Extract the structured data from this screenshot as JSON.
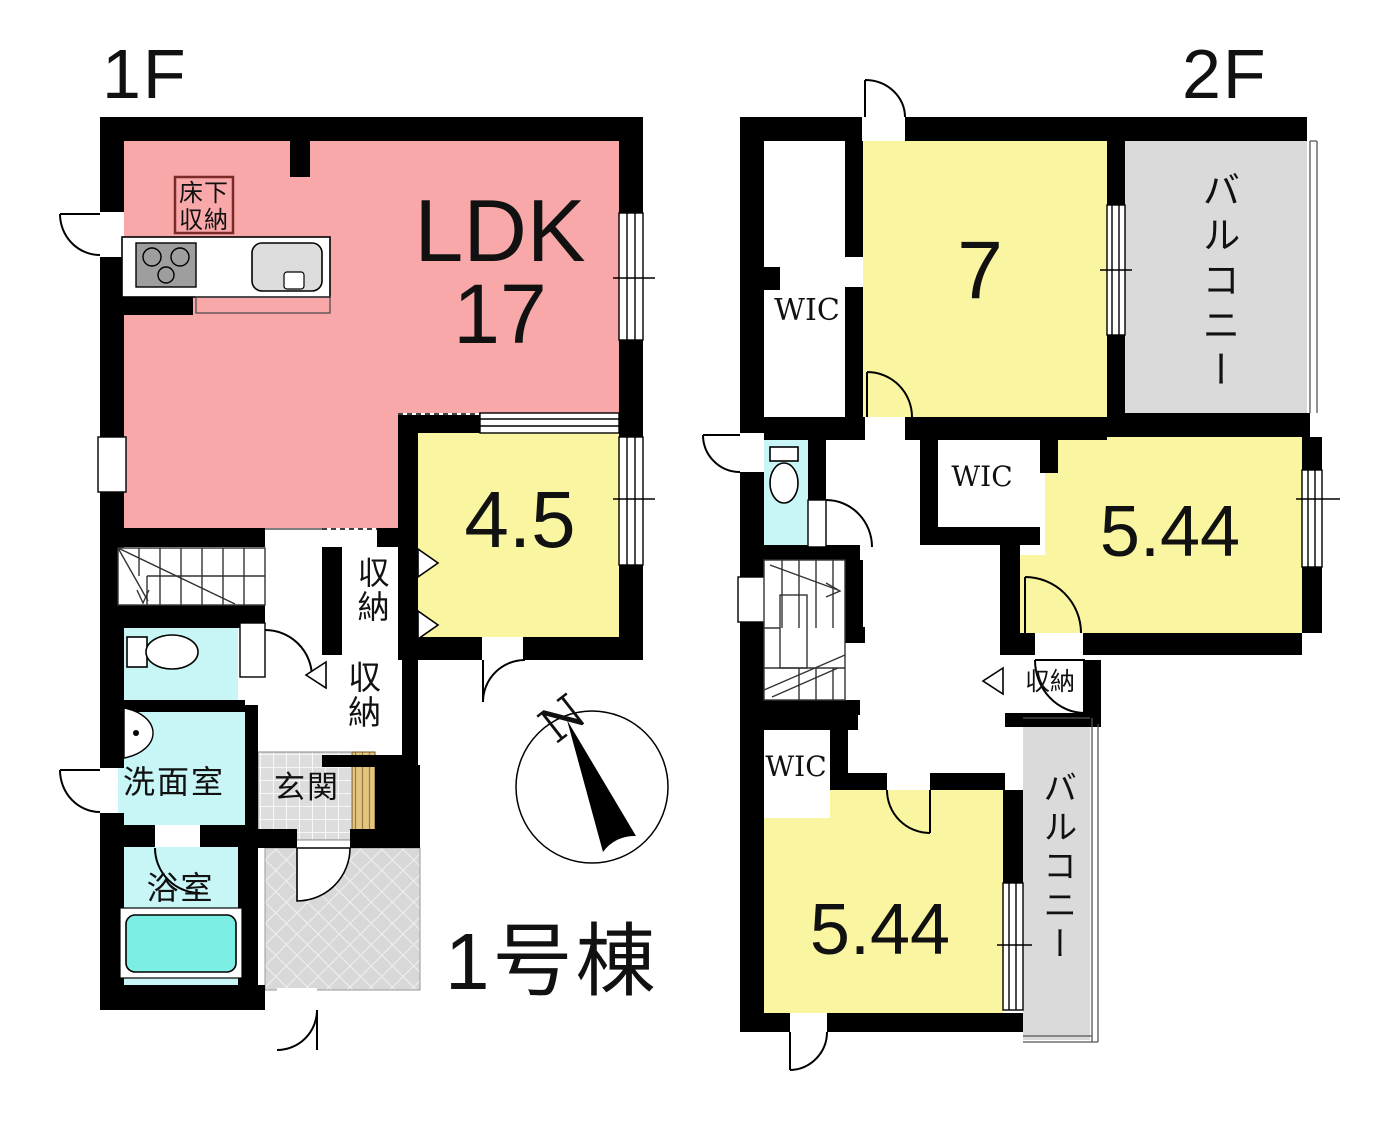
{
  "building_label": "1号棟",
  "compass": {
    "north": "N"
  },
  "floor1": {
    "label": "1F",
    "ldk": {
      "line1": "LDK",
      "line2": "17"
    },
    "underfloor_storage": {
      "line1": "床下",
      "line2": "収納"
    },
    "room45": "4.5",
    "storage1": "収納",
    "storage2": "収納",
    "washroom": "洗面室",
    "bathroom": "浴室",
    "entrance": "玄関"
  },
  "floor2": {
    "label": "2F",
    "wic1": "WIC",
    "room7": "7",
    "balcony1": "バルコニー",
    "wic2": "WIC",
    "room544a": "5.44",
    "storage": "収納",
    "wic3": "WIC",
    "room544b": "5.44",
    "balcony2": "バルコニー"
  },
  "colors": {
    "ldk_pink": "#F8A8A8",
    "room_yellow": "#FAF5A0",
    "wet_cyan": "#C8F5F6",
    "bathtub_cyan": "#7CEEE4",
    "balcony_gray": "#DADADA",
    "porch_gray": "#D8D8D8",
    "tile_gray": "#DDDDDD",
    "wood_tan": "#E4C580",
    "wall_black": "#000000",
    "underfloor_box_border": "#7B2A2A"
  }
}
